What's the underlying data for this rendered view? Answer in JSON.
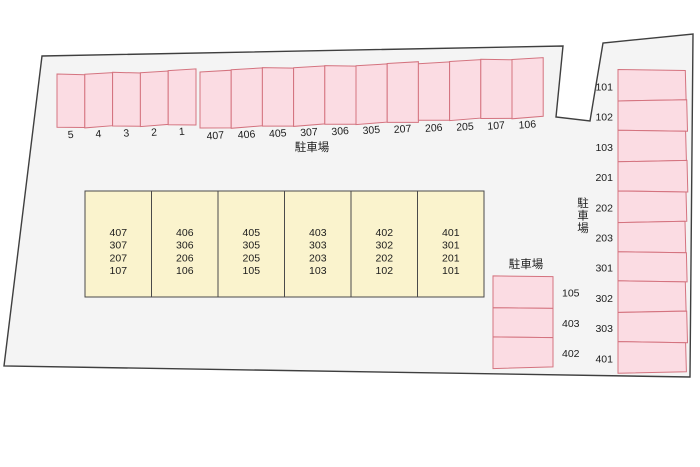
{
  "colors": {
    "site_fill": "#f4f4f4",
    "site_stroke": "#3f3f3f",
    "space_fill": "#fbdce3",
    "space_stroke": "#d4737f",
    "building_fill": "#faf3cd",
    "building_stroke": "#4a4a4a",
    "text": "#1c1c1c"
  },
  "top_row": {
    "label": "駐車場",
    "spaces": [
      "5",
      "4",
      "3",
      "2",
      "1",
      "407",
      "406",
      "405",
      "307",
      "306",
      "305",
      "207",
      "206",
      "205",
      "107",
      "106"
    ]
  },
  "building": {
    "columns": [
      [
        "407",
        "307",
        "207",
        "107"
      ],
      [
        "406",
        "306",
        "206",
        "106"
      ],
      [
        "405",
        "305",
        "205",
        "105"
      ],
      [
        "403",
        "303",
        "203",
        "103"
      ],
      [
        "402",
        "302",
        "202",
        "102"
      ],
      [
        "401",
        "301",
        "201",
        "101"
      ]
    ]
  },
  "bottom_lot": {
    "label": "駐車場",
    "spaces": [
      "105",
      "403",
      "402"
    ]
  },
  "right_lot": {
    "label": "駐車場",
    "spaces": [
      "101",
      "102",
      "103",
      "201",
      "202",
      "203",
      "301",
      "302",
      "303",
      "401"
    ]
  }
}
